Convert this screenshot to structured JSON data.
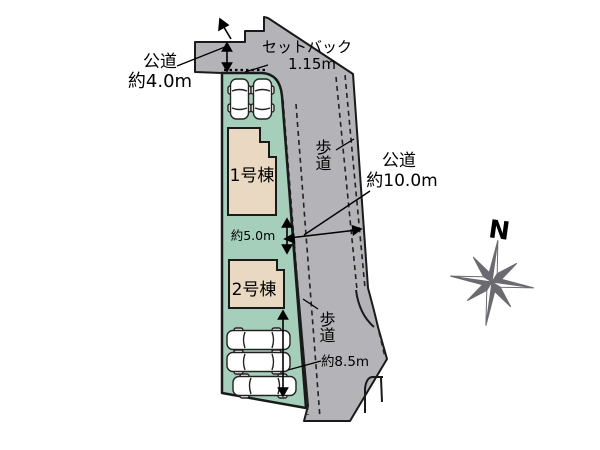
{
  "labels": {
    "road_left_name": "公道",
    "road_left_width": "約4.0m",
    "setback_name": "セットバック",
    "setback_width": "1.15m",
    "sidewalk_upper": "歩道",
    "road_main_name": "公道",
    "road_main_width": "約10.0m",
    "building_gap": "約5.0m",
    "building1": "1号棟",
    "building2": "2号棟",
    "sidewalk_lower": "歩道",
    "parking_depth": "約8.5m",
    "compass_north": "N"
  },
  "colors": {
    "road": "#b4b3b8",
    "plot": "#a6cfbb",
    "building": "#ead9c2",
    "outline": "#1a1a1a",
    "compass": "#6a6a70",
    "car": "#ffffff",
    "background": "#ffffff"
  }
}
